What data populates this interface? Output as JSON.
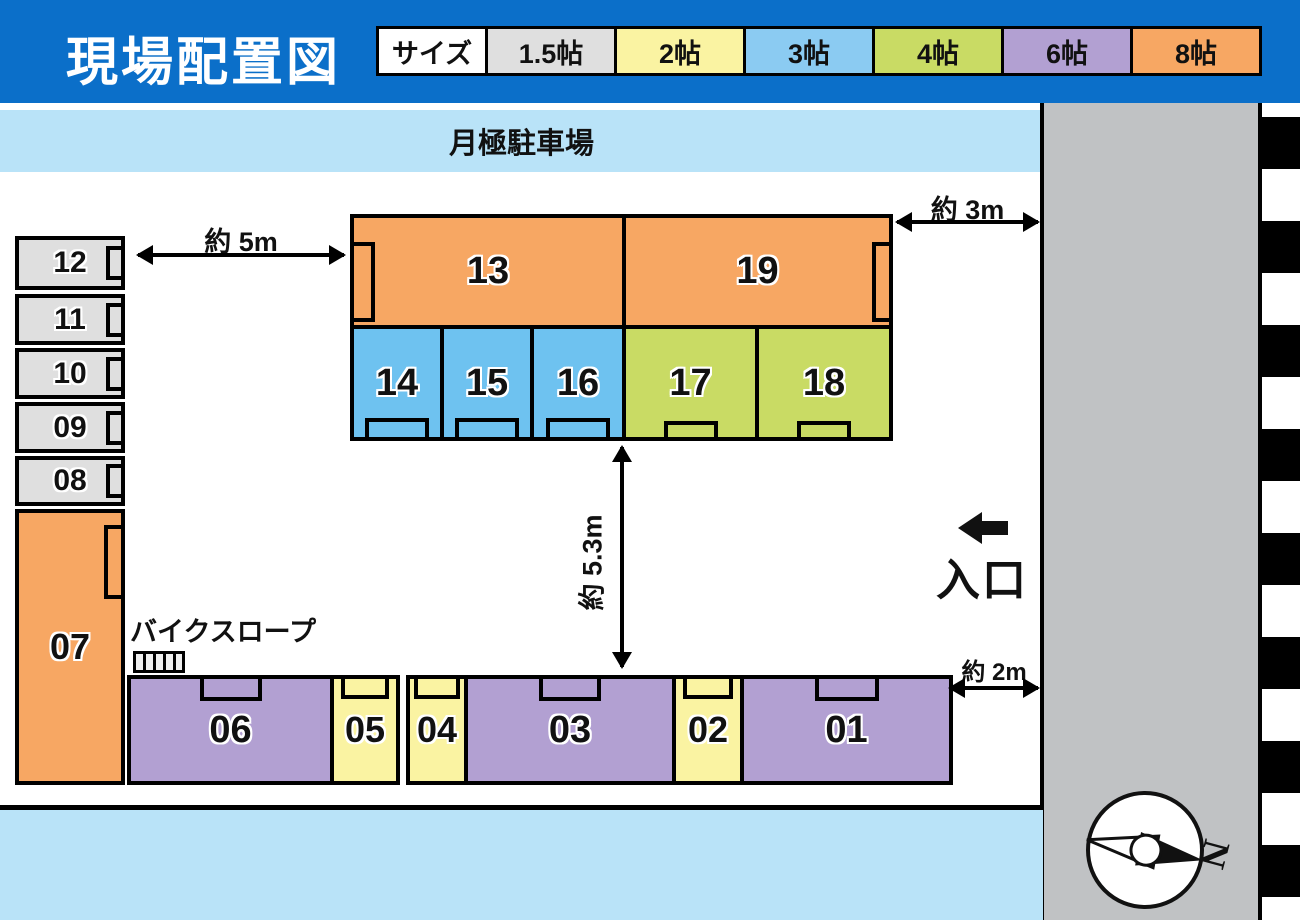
{
  "title": "現場配置図",
  "legend": {
    "header": "サイズ",
    "sizes": [
      {
        "label": "1.5帖",
        "color": "#DFDFDF"
      },
      {
        "label": "2帖",
        "color": "#FAF3A2"
      },
      {
        "label": "3帖",
        "color": "#8BCBF2"
      },
      {
        "label": "4帖",
        "color": "#C9DB64"
      },
      {
        "label": "6帖",
        "color": "#B2A0D2"
      },
      {
        "label": "8帖",
        "color": "#F7A763"
      }
    ]
  },
  "parking": {
    "label": "月極駐車場"
  },
  "dimensions": {
    "left_gap": "約 5m",
    "right_gap": "約 3m",
    "center_gap": "約 5.3m",
    "bottom_gap": "約 2m"
  },
  "bike_ramp": {
    "label": "バイクスロープ"
  },
  "entrance": {
    "label": "入口"
  },
  "compass": {
    "label": "N"
  },
  "units": {
    "u01": {
      "label": "01",
      "size": "6帖"
    },
    "u02": {
      "label": "02",
      "size": "2帖"
    },
    "u03": {
      "label": "03",
      "size": "6帖"
    },
    "u04": {
      "label": "04",
      "size": "2帖"
    },
    "u05": {
      "label": "05",
      "size": "2帖"
    },
    "u06": {
      "label": "06",
      "size": "6帖"
    },
    "u07": {
      "label": "07",
      "size": "8帖"
    },
    "u08": {
      "label": "08",
      "size": "1.5帖"
    },
    "u09": {
      "label": "09",
      "size": "1.5帖"
    },
    "u10": {
      "label": "10",
      "size": "1.5帖"
    },
    "u11": {
      "label": "11",
      "size": "1.5帖"
    },
    "u12": {
      "label": "12",
      "size": "1.5帖"
    },
    "u13": {
      "label": "13",
      "size": "8帖"
    },
    "u14": {
      "label": "14",
      "size": "3帖"
    },
    "u15": {
      "label": "15",
      "size": "3帖"
    },
    "u16": {
      "label": "16",
      "size": "3帖"
    },
    "u17": {
      "label": "17",
      "size": "4帖"
    },
    "u18": {
      "label": "18",
      "size": "4帖"
    },
    "u19": {
      "label": "19",
      "size": "8帖"
    }
  }
}
